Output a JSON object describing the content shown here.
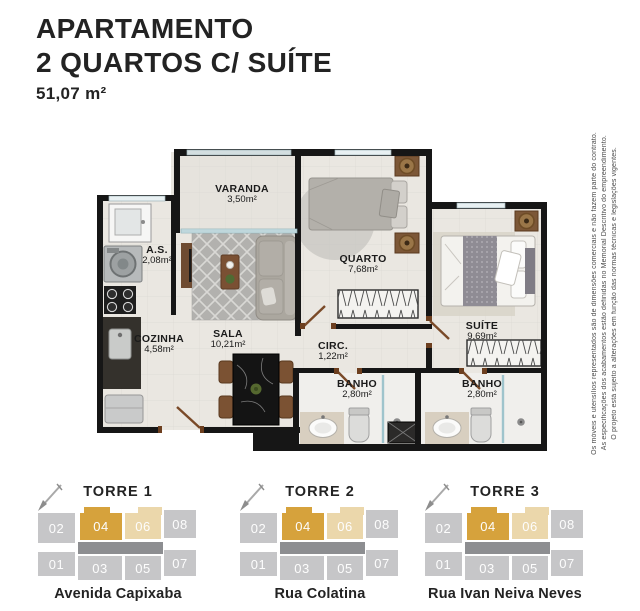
{
  "header": {
    "line1": "APARTAMENTO",
    "line2": "2 QUARTOS C/ SUÍTE",
    "area": "51,07 m²"
  },
  "plan": {
    "rooms": [
      {
        "id": "varanda",
        "name": "VARANDA",
        "area": "3,50m²"
      },
      {
        "id": "as",
        "name": "A.S.",
        "area": "2,08m²"
      },
      {
        "id": "quarto",
        "name": "QUARTO",
        "area": "7,68m²"
      },
      {
        "id": "cozinha",
        "name": "COZINHA",
        "area": "4,58m²"
      },
      {
        "id": "sala",
        "name": "SALA",
        "area": "10,21m²"
      },
      {
        "id": "circ",
        "name": "CIRC.",
        "area": "1,22m²"
      },
      {
        "id": "suite",
        "name": "SUÍTE",
        "area": "9,69m²"
      },
      {
        "id": "banho1",
        "name": "BANHO",
        "area": "2,80m²"
      },
      {
        "id": "banho2",
        "name": "BANHO",
        "area": "2,80m²"
      }
    ]
  },
  "disclaimer": [
    "Os móveis e utensílios representados são de dimensões comerciais e não fazem parte do contrato.",
    "As especificações dos acabamentos estão definidas no Memorial Descritivo do empreendimento.",
    "O projeto está sujeito a alterações em função das normas técnicas e legislações vigentes."
  ],
  "towers": [
    {
      "name": "TORRE 1",
      "street": "Avenida Capixaba",
      "top": [
        "02",
        "04",
        "06",
        "08"
      ],
      "bottom": [
        "01",
        "03",
        "05",
        "07"
      ],
      "highlighted_unit": "04",
      "secondary_unit": "06"
    },
    {
      "name": "TORRE 2",
      "street": "Rua Colatina",
      "top": [
        "02",
        "04",
        "06",
        "08"
      ],
      "bottom": [
        "01",
        "03",
        "05",
        "07"
      ],
      "highlighted_unit": "04",
      "secondary_unit": "06"
    },
    {
      "name": "TORRE 3",
      "street": "Rua Ivan Neiva Neves",
      "top": [
        "02",
        "04",
        "06",
        "08"
      ],
      "bottom": [
        "01",
        "03",
        "05",
        "07"
      ],
      "highlighted_unit": "04",
      "secondary_unit": "06"
    }
  ],
  "colors": {
    "highlight_unit": "#d6a23c",
    "secondary_unit": "#ebd7ab",
    "unit_gray": "#c6c6c8",
    "corridor_gray": "#8d8e91",
    "wall_black": "#161616"
  }
}
